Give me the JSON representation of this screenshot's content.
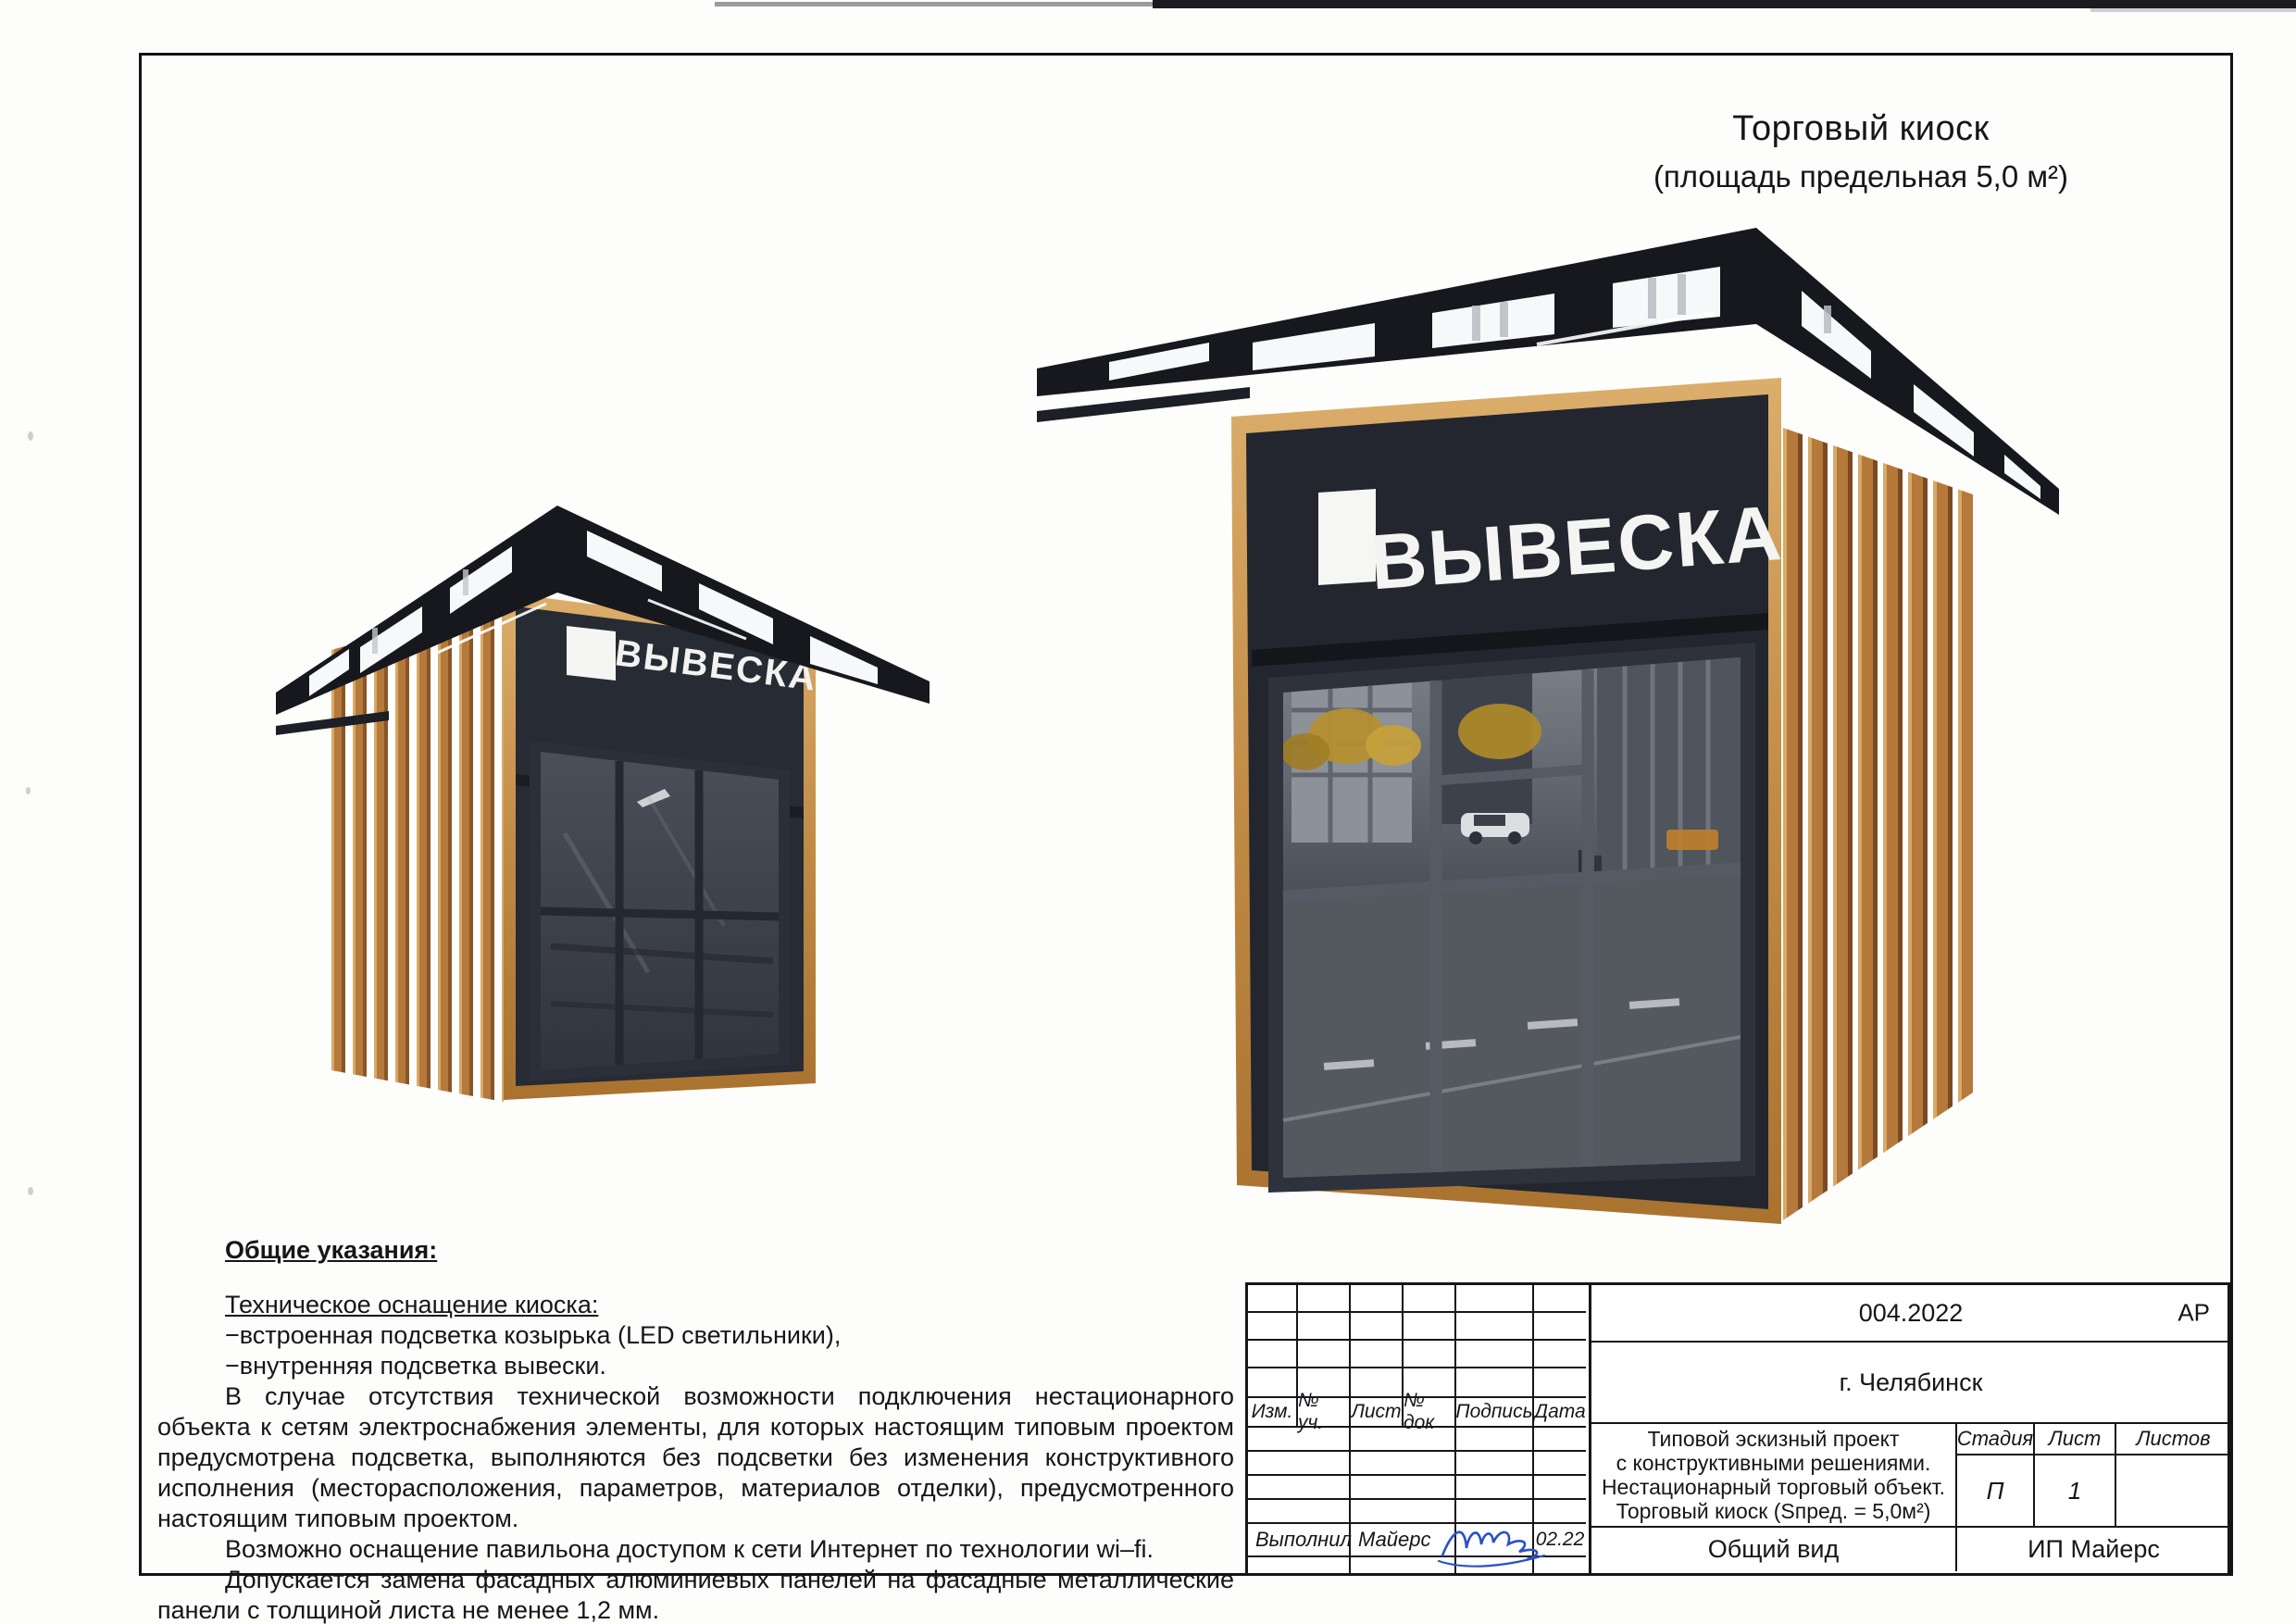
{
  "page": {
    "title_line1": "Торговый киоск",
    "title_line2": "(площадь предельная 5,0 м²)"
  },
  "kiosk": {
    "sign_text": "ВЫВЕСКА",
    "glass_reflection_text": "OF PO DAM",
    "colors": {
      "facade_dark": "#23262f",
      "roof_dark": "#17181d",
      "wood_light": "#d8a967",
      "wood_mid": "#b5793c",
      "signature_blue": "#2b50c8"
    }
  },
  "notes": {
    "heading": "Общие указания:",
    "subheading": "Техническое оснащение киоска:",
    "bullets": [
      "−встроенная подсветка козырька (LED светильники),",
      "−внутренняя подсветка вывески."
    ],
    "paragraphs": [
      "В случае отсутствия технической возможности подключения нестационарного объекта к сетям электроснабжения элементы, для которых настоящим типовым проектом  предусмотрена подсветка, выполняются без подсветки без изменения конструктивного исполнения (месторасположения, параметров, материалов отделки), предусмотренного настоящим типовым проектом.",
      "Возможно оснащение павильона доступом к сети Интернет по технологии wi–fi.",
      "Допускается замена фасадных алюминиевых панелей на фасадные металлические панели с толщиной листа не менее 1,2 мм."
    ]
  },
  "title_block": {
    "doc_number": "004.2022",
    "doc_code": "АР",
    "city": "г. Челябинск",
    "revision_columns": [
      "Изм.",
      "№ уч.",
      "Лист",
      "№ док",
      "Подпись",
      "Дата"
    ],
    "project_lines": [
      "Типовой эскизный проект",
      "с конструктивными решениями.",
      "Нестационарный торговый объект.",
      "Торговый киоск (Sпред. = 5,0м²)"
    ],
    "stage_headers": [
      "Стадия",
      "Лист",
      "Листов"
    ],
    "stage": "П",
    "sheet_number": "1",
    "sheets_total": "",
    "view_name": "Общий вид",
    "company": "ИП Майерс",
    "executor_label": "Выполнил",
    "executor_name": "Майерс",
    "date": "02.22"
  }
}
